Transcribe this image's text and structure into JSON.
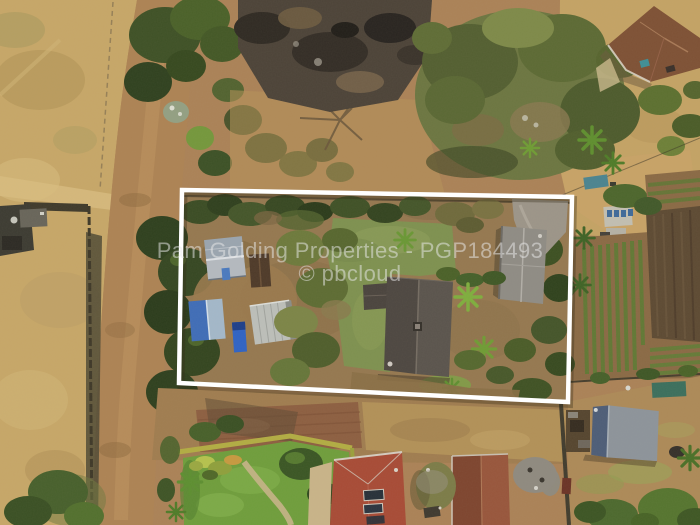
{
  "photo": {
    "type": "aerial-drone-photograph",
    "subject": "Top-down aerial view of a smallholding property outlined in white beside a dirt road, with neighbouring houses, burnt veld and vegetable gardens",
    "width_px": 700,
    "height_px": 525
  },
  "watermark": {
    "line1": "Pam Golding Properties - PGP184493",
    "line2": "© pbcloud",
    "color": "#e9e9e9",
    "opacity": 0.52
  },
  "property_outline": {
    "points": "182,190 572,197 568,402 179,383",
    "shadow_points": "184,192.5 573.5,199.5 569.5,404.5 181,385.5",
    "stroke_color": "#ffffff",
    "stroke_width": 4.5
  },
  "palette": {
    "dry_field": "#c7a768",
    "dirt_road": "#ad8354",
    "lawn_green": "#7e9150",
    "tree_dark_green": "#33451f",
    "burnt_ground": "#4c4338",
    "main_roof_gray": "#55504a",
    "cottage_roof_gray": "#8f8c85",
    "red_roof": "#a84b36",
    "red_brown_roof": "#8a4a33",
    "blue_tarp": "#3f6db8",
    "shed_roof_gray_blue": "#8d949b",
    "tilled_soil": "#5d4a33",
    "crop_row_green": "#5a7c33"
  },
  "scene_features": [
    "dirt-road",
    "boundary-fence",
    "burnt-veld",
    "tree-canopy",
    "outlined-property",
    "main-house",
    "cottage",
    "farm-sheds",
    "blue-tarp",
    "lawn",
    "driveway",
    "vegetable-garden",
    "tilled-field",
    "neighbour-red-roof-houses",
    "garden-shed",
    "bottom-garden-lawn"
  ]
}
